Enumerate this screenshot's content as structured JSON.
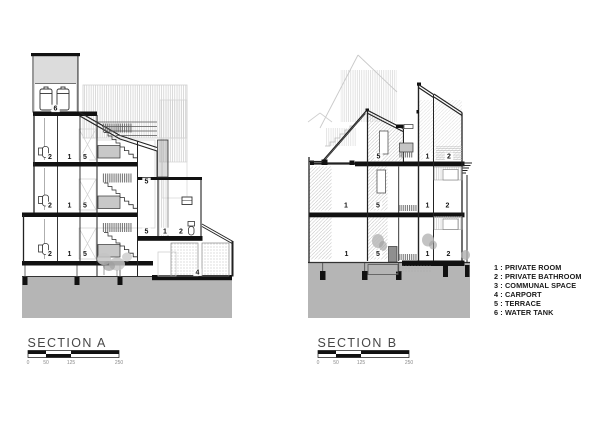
{
  "section_a": {
    "title": "SECTION A",
    "annotations": [
      {
        "t": "6",
        "x": 55.5,
        "y": 110.5
      },
      {
        "t": "2",
        "x": 50,
        "y": 159
      },
      {
        "t": "1",
        "x": 69.5,
        "y": 159
      },
      {
        "t": "5",
        "x": 85,
        "y": 159
      },
      {
        "t": "2",
        "x": 50,
        "y": 207.5
      },
      {
        "t": "1",
        "x": 69.5,
        "y": 207.5
      },
      {
        "t": "5",
        "x": 85,
        "y": 207.5
      },
      {
        "t": "2",
        "x": 50,
        "y": 256
      },
      {
        "t": "1",
        "x": 69.5,
        "y": 256
      },
      {
        "t": "5",
        "x": 85,
        "y": 256
      },
      {
        "t": "5",
        "x": 146.5,
        "y": 183.5
      },
      {
        "t": "5",
        "x": 146.5,
        "y": 233.5
      },
      {
        "t": "1",
        "x": 165,
        "y": 233.5
      },
      {
        "t": "2",
        "x": 181,
        "y": 233.5
      },
      {
        "t": "4",
        "x": 197.5,
        "y": 274.5
      }
    ]
  },
  "section_b": {
    "title": "SECTION B",
    "annotations": [
      {
        "t": "5",
        "x": 378.5,
        "y": 158.5
      },
      {
        "t": "1",
        "x": 427.5,
        "y": 158.5
      },
      {
        "t": "2",
        "x": 449,
        "y": 158.5
      },
      {
        "t": "1",
        "x": 346,
        "y": 207.5
      },
      {
        "t": "5",
        "x": 378,
        "y": 207.5
      },
      {
        "t": "1",
        "x": 427.5,
        "y": 207.5
      },
      {
        "t": "2",
        "x": 447.5,
        "y": 207.5
      },
      {
        "t": "1",
        "x": 346.5,
        "y": 256
      },
      {
        "t": "5",
        "x": 378,
        "y": 256
      },
      {
        "t": "1",
        "x": 427.5,
        "y": 256
      },
      {
        "t": "2",
        "x": 448.5,
        "y": 256
      }
    ]
  },
  "scalebar": {
    "ticks": [
      "0",
      "50",
      "125",
      "250"
    ]
  },
  "legend": {
    "items": [
      {
        "text": "1 : PRIVATE ROOM"
      },
      {
        "text": "2 : PRIVATE BATHROOM"
      },
      {
        "text": "3 : COMMUNAL SPACE"
      },
      {
        "text": "4 : CARPORT"
      },
      {
        "text": "5 : TERRACE"
      },
      {
        "text": "6 : WATER TANK"
      }
    ]
  },
  "colors": {
    "ground": "#b5b5b5",
    "slab": "#111111",
    "line": "#222222",
    "landing": "#c8c8c8"
  }
}
